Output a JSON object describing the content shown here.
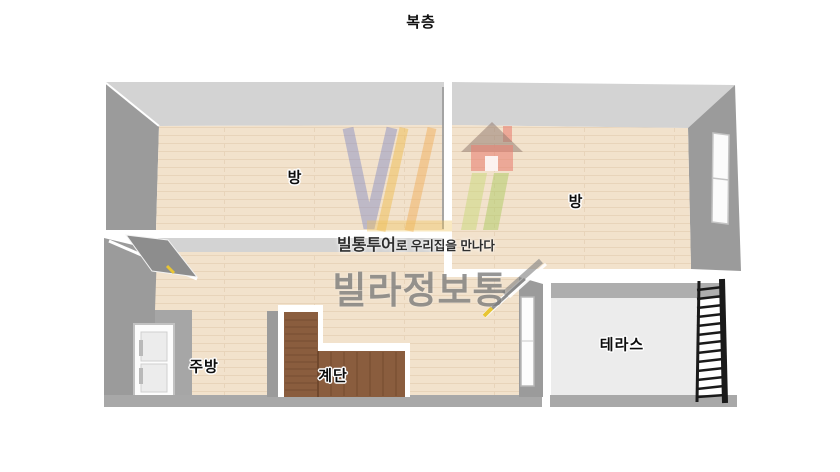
{
  "title": "복층",
  "colors": {
    "wall_light": "#d3d3d3",
    "wall_dark": "#9b9b9b",
    "wall_mid": "#a6a6a6",
    "wall_bottom": "#a8a8a8",
    "floor": "#f2e2cc",
    "floor_line": "#dcc4a4",
    "stairs": "#8a5d3e",
    "terrace_floor": "#ececec",
    "ladder": "#1a1a1a",
    "accent_yellow": "#e8c534",
    "label_text": "#0d0d0d",
    "watermark_gray": "#7d7d7d"
  },
  "rooms": {
    "room_top_left": {
      "label": "방"
    },
    "room_top_right": {
      "label": "방"
    },
    "kitchen": {
      "label": "주방"
    },
    "stairs": {
      "label": "계단"
    },
    "terrace": {
      "label": "테라스"
    }
  },
  "watermark": {
    "tagline_bold": "빌통투어",
    "tagline_rest": "로 우리집을 만나다",
    "brand": "빌라정보통"
  }
}
